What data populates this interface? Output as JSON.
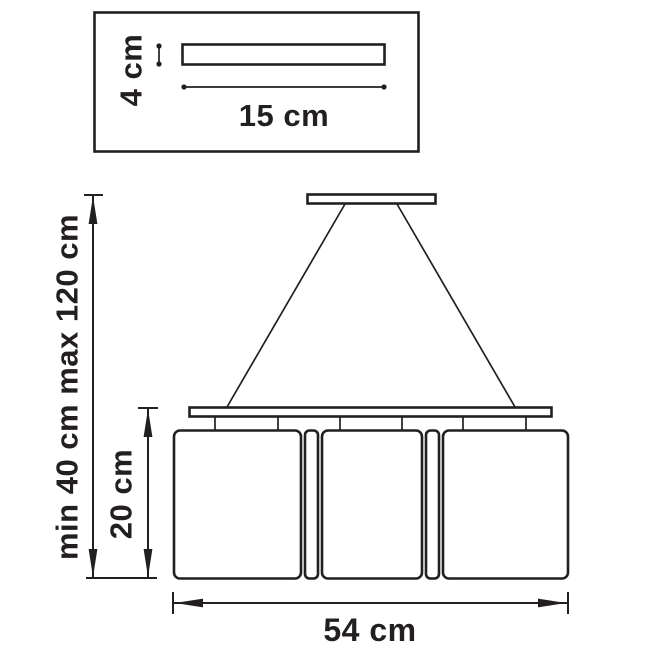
{
  "colors": {
    "ink": "#231f20",
    "bg": "#ffffff"
  },
  "canopy_detail": {
    "height_label": "4 cm",
    "width_label": "15 cm"
  },
  "pendant": {
    "suspension_range_label": "min 40 cm max 120 cm",
    "shade_height_label": "20 cm",
    "fixture_width_label": "54 cm",
    "shade_count": 3
  }
}
